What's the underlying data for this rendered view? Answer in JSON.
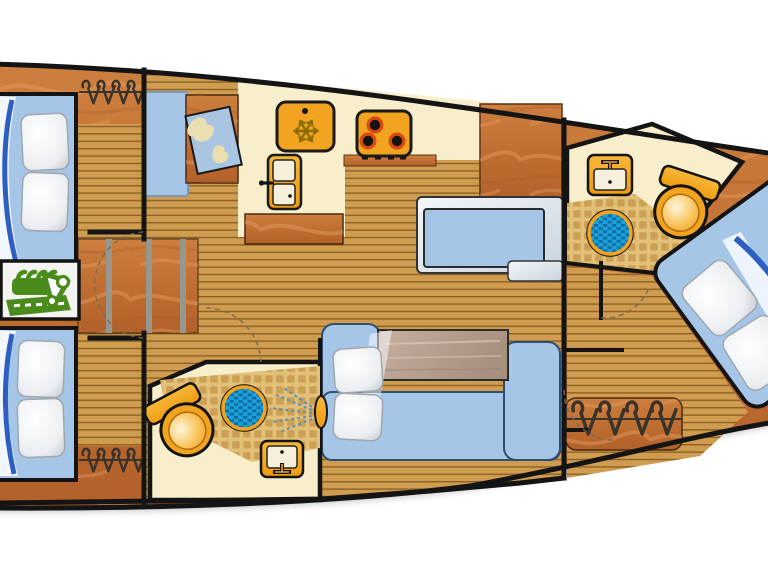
{
  "diagram": {
    "type": "boat-floor-plan",
    "view": "top-down interior deck layout of a sailing yacht",
    "rooms": [
      {
        "name": "port-forward-cabin",
        "features": [
          "double-berth",
          "two-pillows",
          "wardrobe-hangers",
          "plank-floor"
        ]
      },
      {
        "name": "engine-compartment",
        "features": [
          "engine-icon"
        ]
      },
      {
        "name": "port-aft-cabin",
        "features": [
          "double-berth",
          "two-pillows",
          "wardrobe-hangers",
          "plank-floor"
        ]
      },
      {
        "name": "galley",
        "features": [
          "fridge-snowflake",
          "stove-three-burners",
          "locker-door",
          "counter",
          "island-table"
        ]
      },
      {
        "name": "nav-station",
        "features": [
          "chart-table",
          "sea-chart-map",
          "seat"
        ]
      },
      {
        "name": "saloon",
        "features": [
          "upper-settee",
          "lower-settee",
          "saloon-table",
          "pillows",
          "plank-floor"
        ]
      },
      {
        "name": "center-head",
        "features": [
          "toilet",
          "sink",
          "shower-drain",
          "shower-spray",
          "tiled-floor"
        ]
      },
      {
        "name": "starboard-head",
        "features": [
          "toilet",
          "sink",
          "shower-drain",
          "tiled-floor"
        ]
      },
      {
        "name": "starboard-aft-cabin",
        "features": [
          "rotated-double-berth",
          "two-pillows",
          "wardrobe-hangers"
        ]
      }
    ],
    "icons": [
      "engine-icon",
      "snowflake-icon",
      "burner-icon",
      "door-handle-icon",
      "map-icon",
      "faucet-icon",
      "toilet-icon",
      "drain-icon",
      "shower-spray-icon",
      "hanger-icon"
    ]
  },
  "colors": {
    "hull_wood_light": "#cd7f3f",
    "hull_wood_dark": "#b2612a",
    "plank": "#d09c50",
    "plank_line": "#8a6226",
    "cream": "#f8eecb",
    "tile_base": "#e3c078",
    "tile_square": "#c79a4e",
    "bed_blue": "#a6c6e8",
    "silver": "#e7edf3",
    "orange": "#f2a31f",
    "burner_glow": "#d84a10",
    "drain_blue": "#1da0d6",
    "drain_dark": "#0d6aa6",
    "engine_green": "#4a8c1c",
    "wall": "#141414",
    "table_gray": "#b7a190",
    "blanket_blue": "#2e5fc0",
    "panel_cream": "#f6efdc"
  }
}
